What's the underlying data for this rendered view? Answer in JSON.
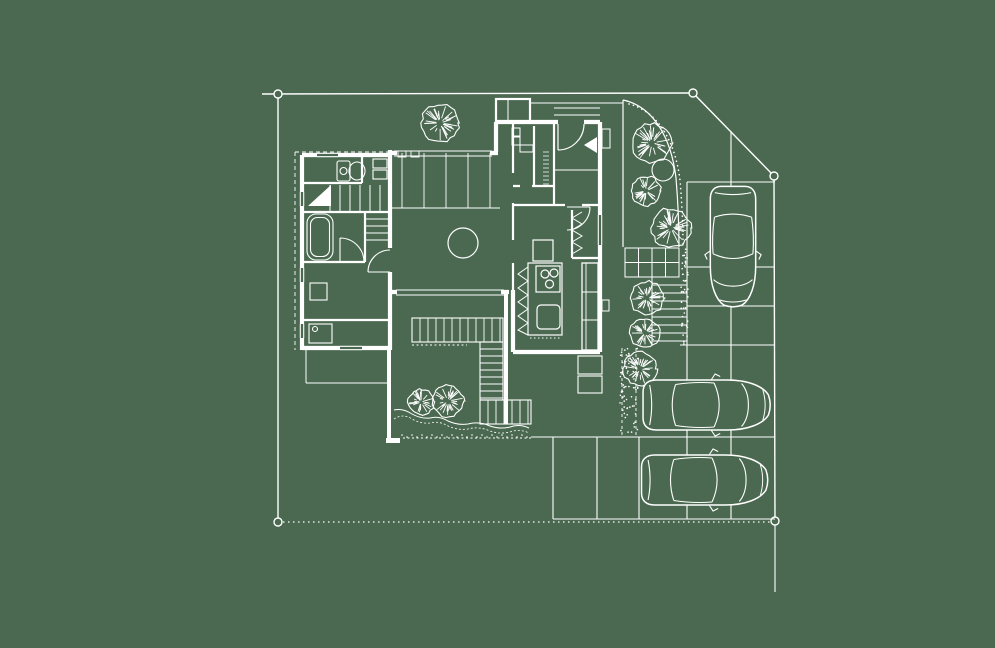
{
  "palette": {
    "background": "#4b6951",
    "line": "#ffffff"
  },
  "canvas": {
    "width": 995,
    "height": 648
  },
  "drawing_type": "residential-site-plan",
  "boundary": {
    "marker_radius": 4,
    "markers": [
      [
        278,
        94
      ],
      [
        693,
        93
      ],
      [
        774,
        176
      ],
      [
        775,
        521
      ],
      [
        278,
        522
      ]
    ],
    "solid_lines": [
      [
        262,
        94,
        693,
        93
      ],
      [
        693,
        93,
        774,
        176
      ],
      [
        774,
        176,
        775,
        521
      ],
      [
        278,
        94,
        278,
        522
      ]
    ],
    "dotted_lines": [
      [
        278,
        522,
        775,
        522
      ]
    ],
    "extension_lines": [
      [
        775,
        521,
        775,
        592
      ]
    ]
  },
  "parking": {
    "lines": [
      [
        687,
        182,
        687,
        519
      ],
      [
        731,
        131,
        731,
        519
      ],
      [
        553,
        437,
        553,
        519
      ],
      [
        597,
        437,
        597,
        519
      ],
      [
        639,
        437,
        639,
        519
      ],
      [
        687,
        182,
        775,
        182
      ],
      [
        687,
        267,
        775,
        267
      ],
      [
        687,
        306,
        775,
        306
      ],
      [
        680,
        345,
        775,
        345
      ],
      [
        531,
        437,
        775,
        437
      ],
      [
        553,
        519,
        775,
        519
      ]
    ]
  },
  "garden": {
    "bed_arc": "M623,100 C652,106 671,136 676,178 C678,202 679,224 679,247",
    "stipple_arc": "M629,104 C657,111 675,140 680,180 C682,204 683,226 683,247",
    "bed_left_edge": [
      623,
      100,
      623,
      247
    ],
    "pavers": {
      "x": 625,
      "y": 248,
      "w": 54,
      "h": 29,
      "cols": 4,
      "rows": 2
    },
    "ladder": {
      "x": 652,
      "y": 277,
      "w": 35,
      "h": 68,
      "step": 8
    },
    "gravel_strip": {
      "x": 681,
      "y": 248,
      "w": 7,
      "h": 97,
      "dots": 46,
      "seed": 9
    },
    "hedge": {
      "x": 620,
      "y": 348,
      "w": 18,
      "h": 88,
      "dots": 70,
      "seed": 7
    }
  },
  "deck": {
    "strips": [
      {
        "x": 412,
        "y": 318,
        "w": 91,
        "h": 24,
        "dir": "v",
        "step": 8
      },
      {
        "x": 480,
        "y": 342,
        "w": 23,
        "h": 58,
        "dir": "h",
        "step": 7
      },
      {
        "x": 480,
        "y": 400,
        "w": 51,
        "h": 24,
        "dir": "v",
        "step": 8
      }
    ],
    "screen_wall": [
      506,
      292,
      506,
      424
    ],
    "left_wall": [
      389,
      348,
      389,
      441
    ],
    "foot": [
      386,
      438,
      14,
      5
    ],
    "dashes": [
      [
        403,
        438,
        532,
        438
      ],
      [
        412,
        345,
        467,
        345
      ]
    ]
  },
  "planting": {
    "wavy_points": [
      [
        394,
        410
      ],
      [
        412,
        414
      ],
      [
        430,
        418
      ],
      [
        448,
        421
      ],
      [
        468,
        424
      ],
      [
        490,
        426
      ],
      [
        510,
        427
      ],
      [
        529,
        428
      ]
    ],
    "dots_row": {
      "x1": 402,
      "x2": 531,
      "y": 435,
      "step": 5
    }
  },
  "trees": [
    {
      "cx": 440,
      "cy": 123,
      "r": 19,
      "seed": 3
    },
    {
      "cx": 652,
      "cy": 143,
      "r": 20,
      "seed": 11
    },
    {
      "cx": 663,
      "cy": 170,
      "r": 11,
      "seed": 5,
      "plain": true
    },
    {
      "cx": 646,
      "cy": 191,
      "r": 15,
      "seed": 7
    },
    {
      "cx": 671,
      "cy": 228,
      "r": 20,
      "seed": 13
    },
    {
      "cx": 647,
      "cy": 298,
      "r": 17,
      "seed": 17
    },
    {
      "cx": 645,
      "cy": 333,
      "r": 15,
      "seed": 19
    },
    {
      "cx": 640,
      "cy": 369,
      "r": 17,
      "seed": 23
    },
    {
      "cx": 421,
      "cy": 402,
      "r": 13,
      "seed": 29
    },
    {
      "cx": 448,
      "cy": 401,
      "r": 16,
      "seed": 31
    }
  ],
  "cars": [
    {
      "cx": 733,
      "cy": 246,
      "length": 125,
      "width": 49,
      "rotation": 90
    },
    {
      "cx": 706,
      "cy": 405,
      "length": 132,
      "width": 54,
      "rotation": 0
    },
    {
      "cx": 704,
      "cy": 480,
      "length": 131,
      "width": 54,
      "rotation": 0
    }
  ]
}
